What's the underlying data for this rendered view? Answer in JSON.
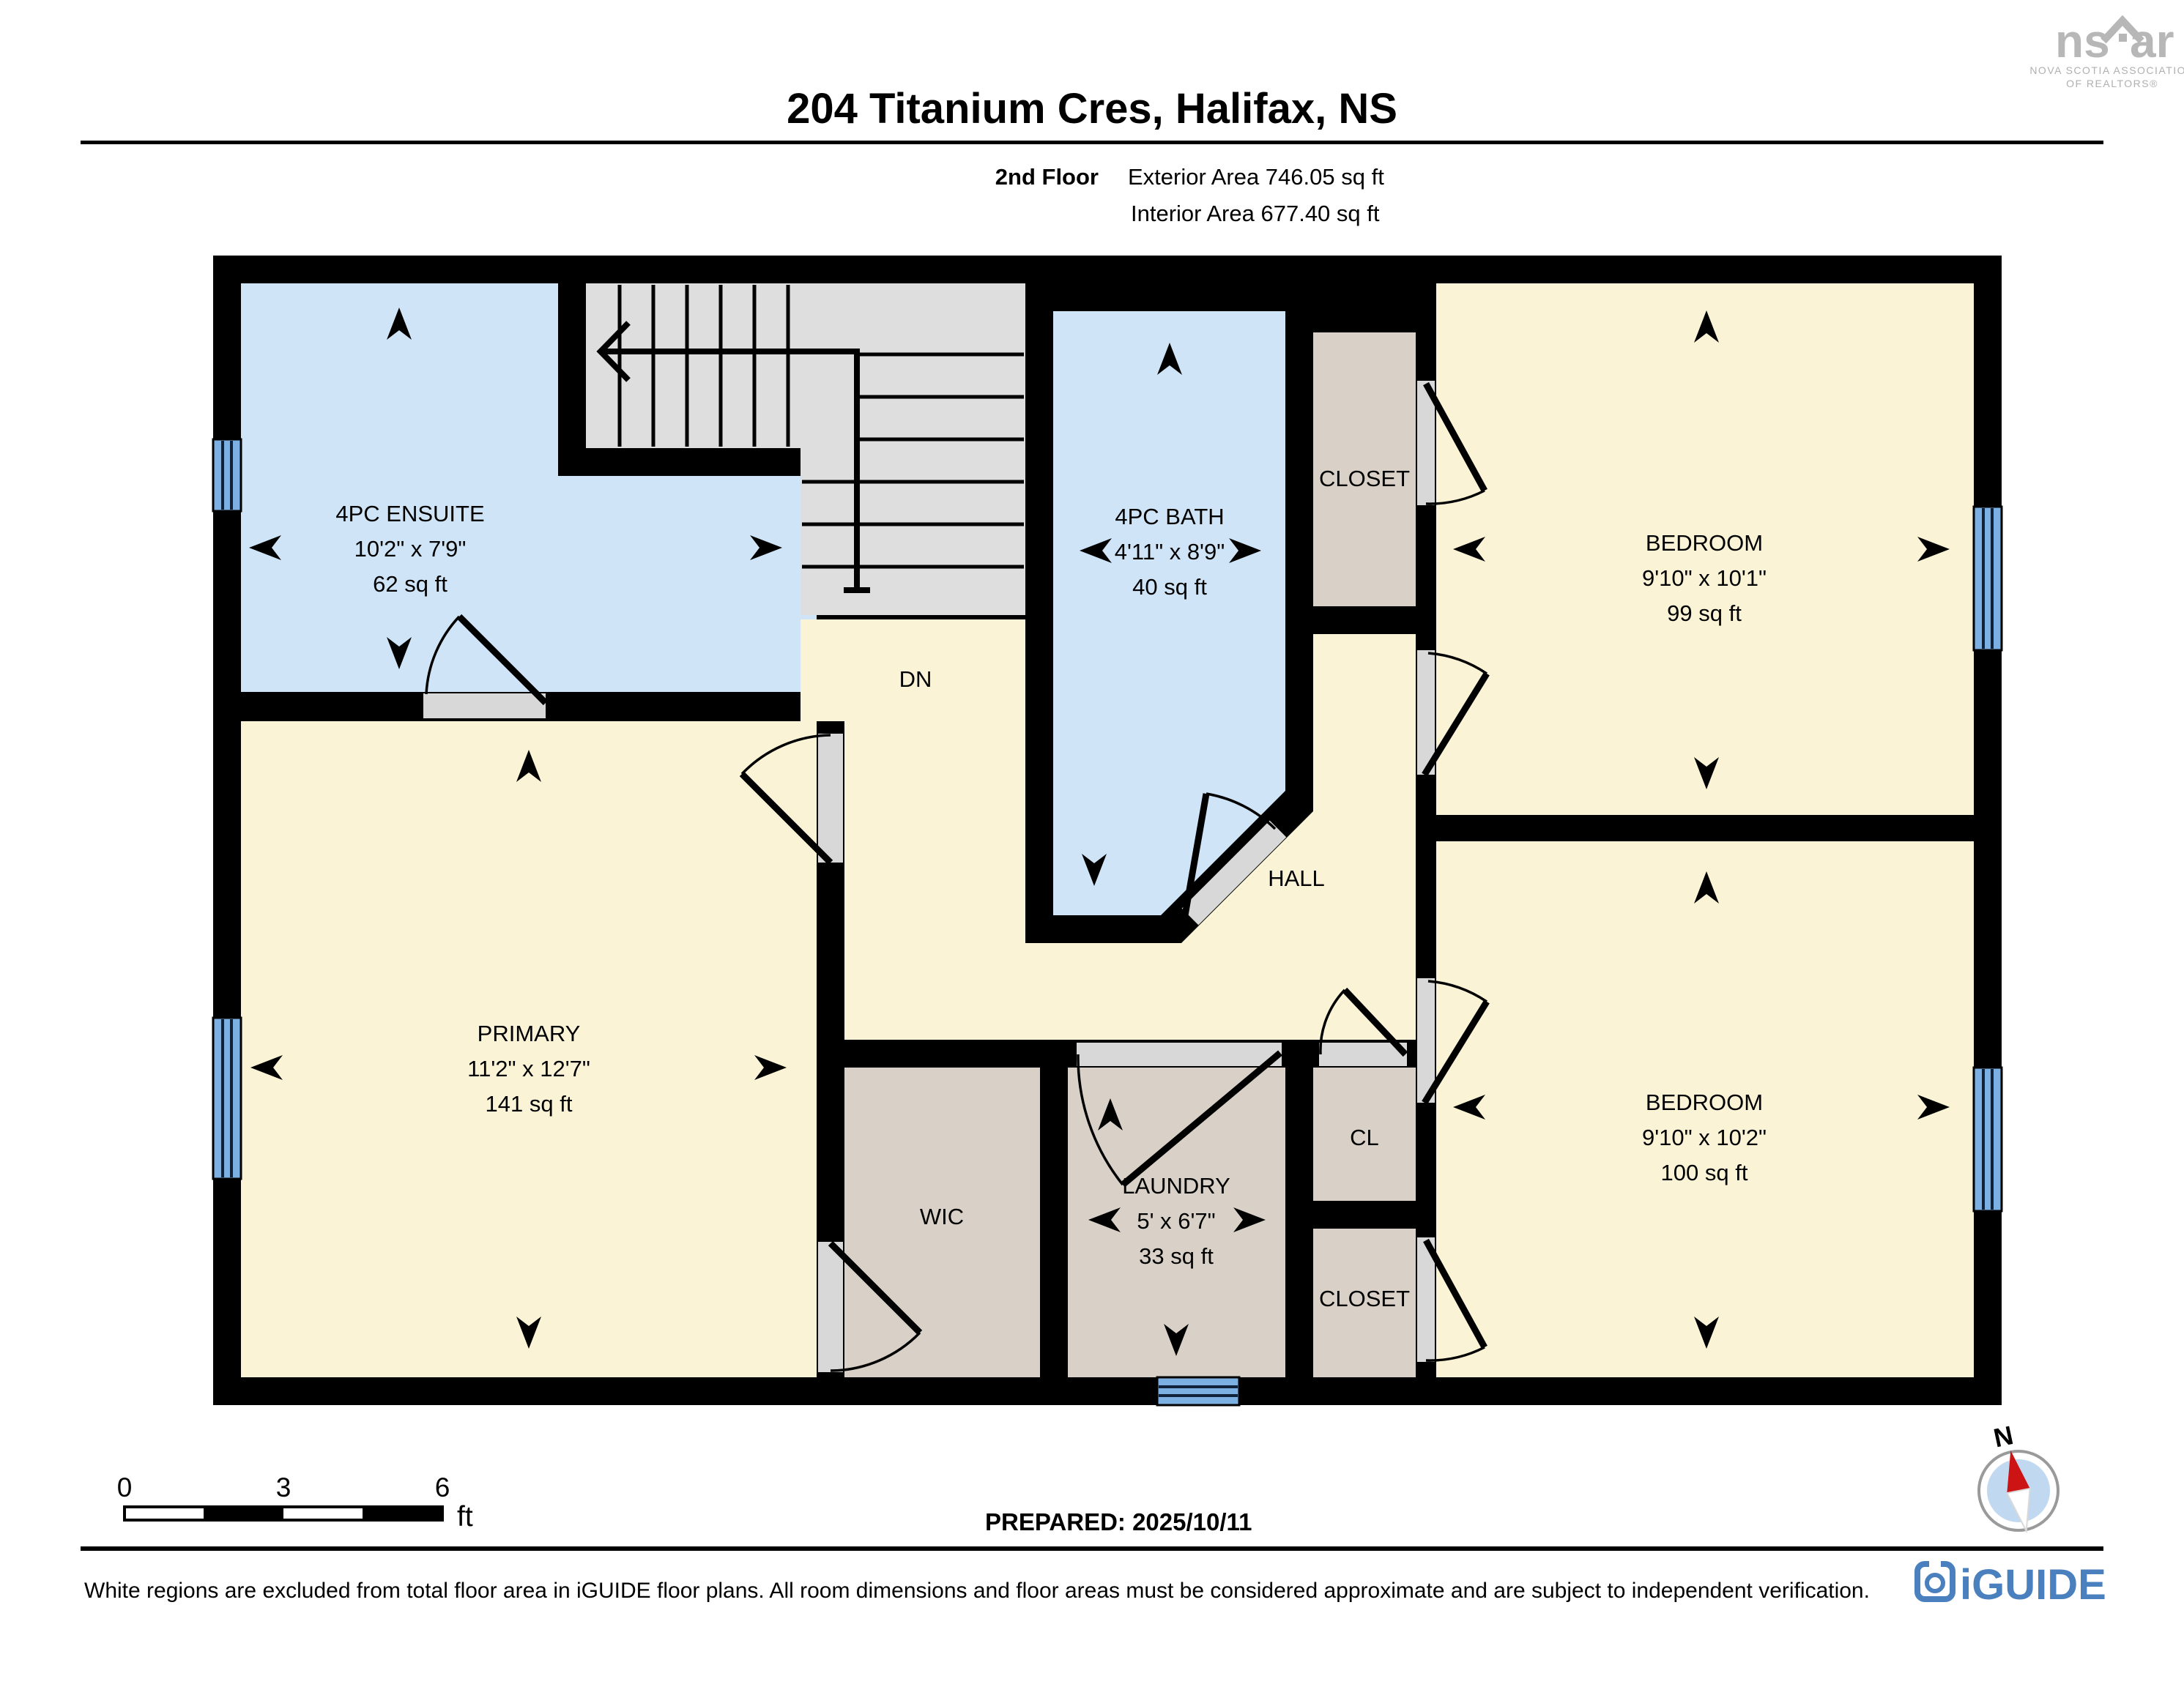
{
  "header": {
    "title": "204 Titanium Cres, Halifax, NS",
    "floor_label": "2nd Floor",
    "exterior_area": "Exterior Area 746.05 sq ft",
    "interior_area": "Interior Area 677.40 sq ft"
  },
  "realtor_logo": {
    "wordmark_left": "ns",
    "wordmark_right": "ar",
    "line1": "NOVA SCOTIA ASSOCIATION",
    "line2": "OF REALTORS®"
  },
  "rooms": {
    "ensuite": {
      "name": "4PC ENSUITE",
      "dims": "10'2\" x 7'9\"",
      "area": "62 sq ft"
    },
    "bath": {
      "name": "4PC BATH",
      "dims": "4'11\" x 8'9\"",
      "area": "40 sq ft"
    },
    "closet_top": {
      "name": "CLOSET"
    },
    "bedroom_top": {
      "name": "BEDROOM",
      "dims": "9'10\" x 10'1\"",
      "area": "99 sq ft"
    },
    "primary": {
      "name": "PRIMARY",
      "dims": "11'2\" x 12'7\"",
      "area": "141 sq ft"
    },
    "hall": {
      "name": "HALL"
    },
    "wic": {
      "name": "WIC"
    },
    "laundry": {
      "name": "LAUNDRY",
      "dims": "5' x 6'7\"",
      "area": "33 sq ft"
    },
    "cl": {
      "name": "CL"
    },
    "closet_bottom": {
      "name": "CLOSET"
    },
    "bedroom_bottom": {
      "name": "BEDROOM",
      "dims": "9'10\" x 10'2\"",
      "area": "100 sq ft"
    }
  },
  "stairs": {
    "label": "DN"
  },
  "scale_bar": {
    "zero": "0",
    "three": "3",
    "six": "6",
    "unit": "ft"
  },
  "prepared_label": "PREPARED: 2025/10/11",
  "compass": {
    "north_label": "N"
  },
  "footer": {
    "disclaimer": "White regions are excluded from total floor area in iGUIDE floor plans. All room dimensions and floor areas must be considered approximate and are subject to independent verification.",
    "brand": "iGUIDE"
  },
  "colors": {
    "wall": "#000000",
    "room_yellow": "#fbf3d6",
    "room_blue": "#cfe4f7",
    "room_tan": "#d9d1c7",
    "stairs_gray": "#dedede",
    "window_blue": "#7cb0e2",
    "iguide_blue": "#4b80bf",
    "logo_gray": "#b7b7b7"
  }
}
